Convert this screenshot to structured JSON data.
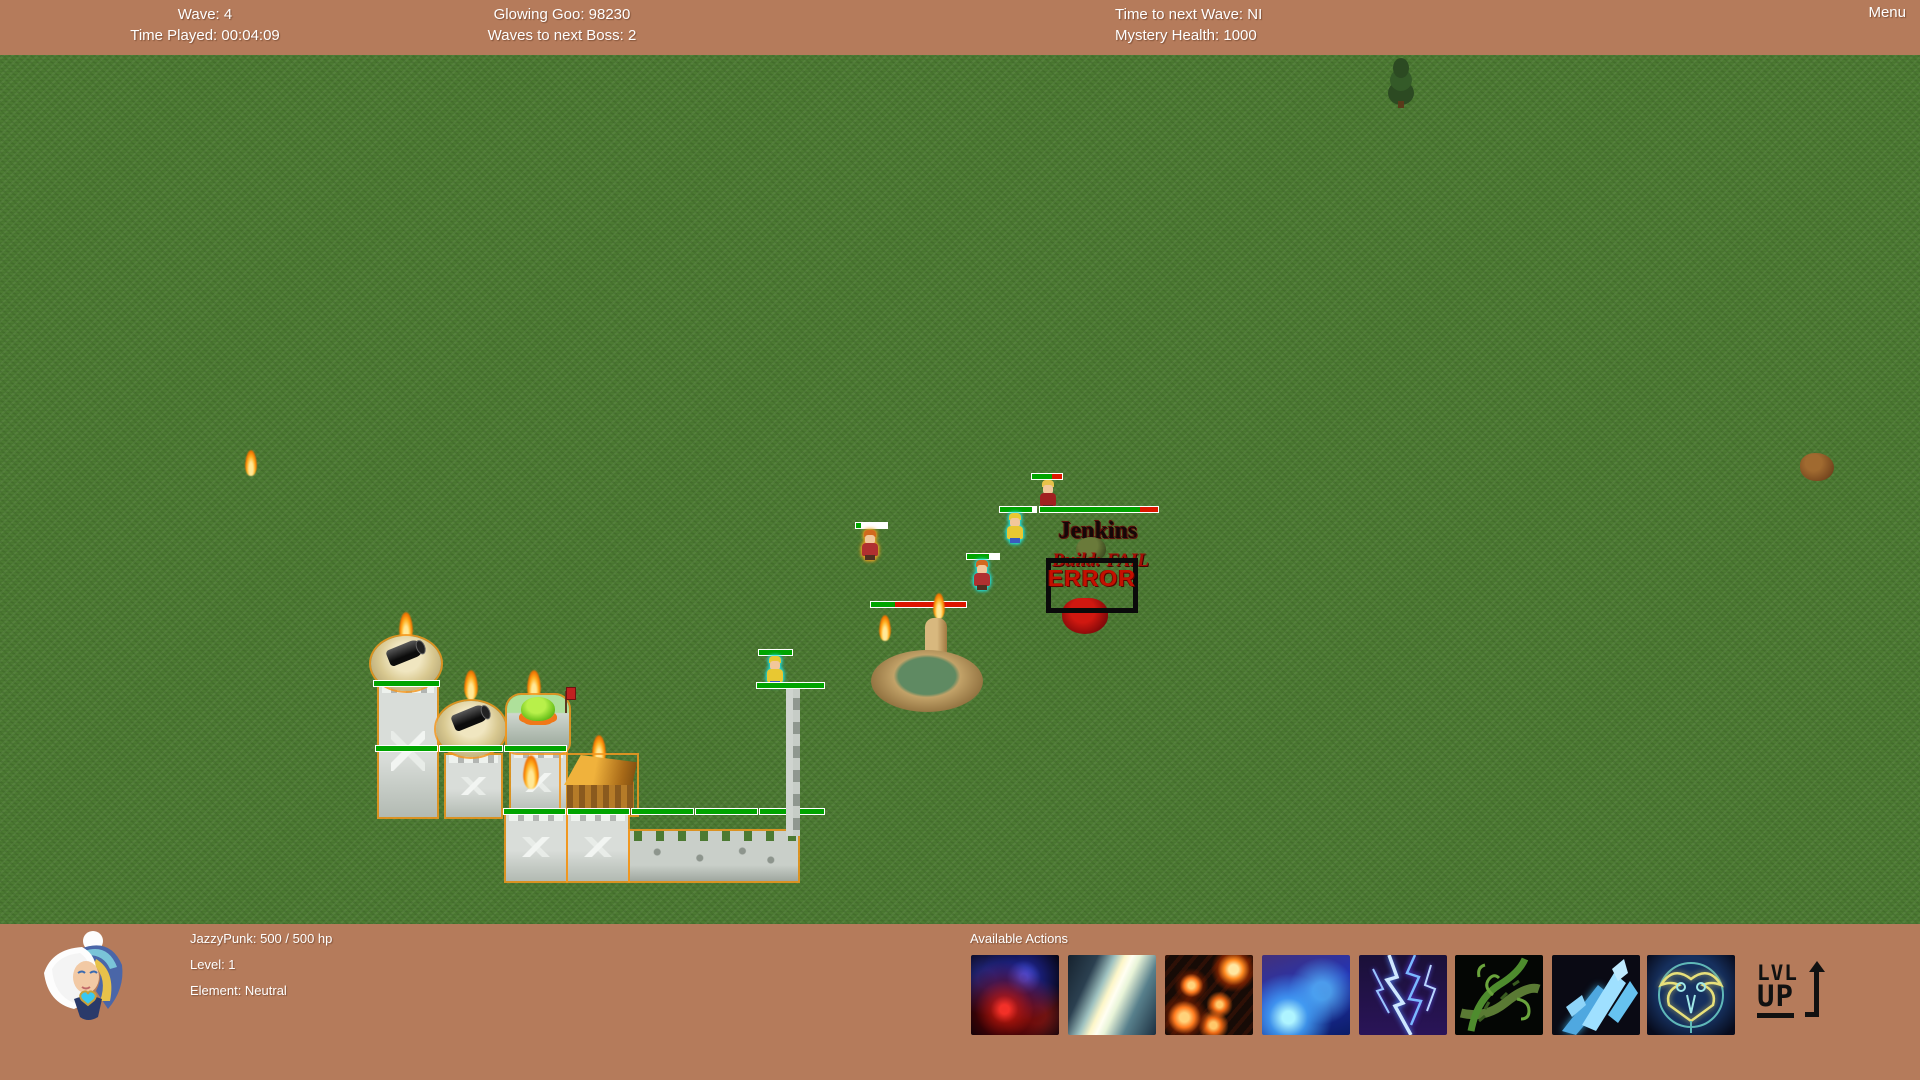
{
  "top_hud": {
    "left": {
      "line1": "Wave: 4",
      "line2": "Time Played: 00:04:09"
    },
    "center": {
      "line1": "Glowing Goo: 98230",
      "line2": "Waves to next Boss: 2"
    },
    "right": {
      "line1": "Time to next Wave: NI",
      "line2": "Mystery Health: 1000"
    },
    "menu_label": "Menu"
  },
  "field": {
    "boss_name": "Jenkins",
    "boss_status": "Build: FAIL",
    "error_label": "ERROR"
  },
  "bottom_hud": {
    "hero_stats": {
      "line1": "JazzyPunk: 500 / 500 hp",
      "line2": "Level: 1",
      "line3": "Element: Neutral"
    },
    "actions_title": "Available Actions",
    "actions": [
      {
        "icon": "red-blue-burst-icon"
      },
      {
        "icon": "light-beam-icon"
      },
      {
        "icon": "meteor-shower-icon"
      },
      {
        "icon": "blue-flame-icon"
      },
      {
        "icon": "lightning-icon"
      },
      {
        "icon": "thorn-vines-icon"
      },
      {
        "icon": "ice-shards-icon"
      },
      {
        "icon": "owl-sigil-icon"
      }
    ],
    "lvl_up": {
      "line1": "LVL",
      "line2": "UP"
    }
  },
  "colors": {
    "hud_bg": "#b57b5b",
    "grass": "#4c7a32",
    "health_green": "#00a400",
    "health_red": "#dd1500",
    "error_red": "#c41000"
  }
}
